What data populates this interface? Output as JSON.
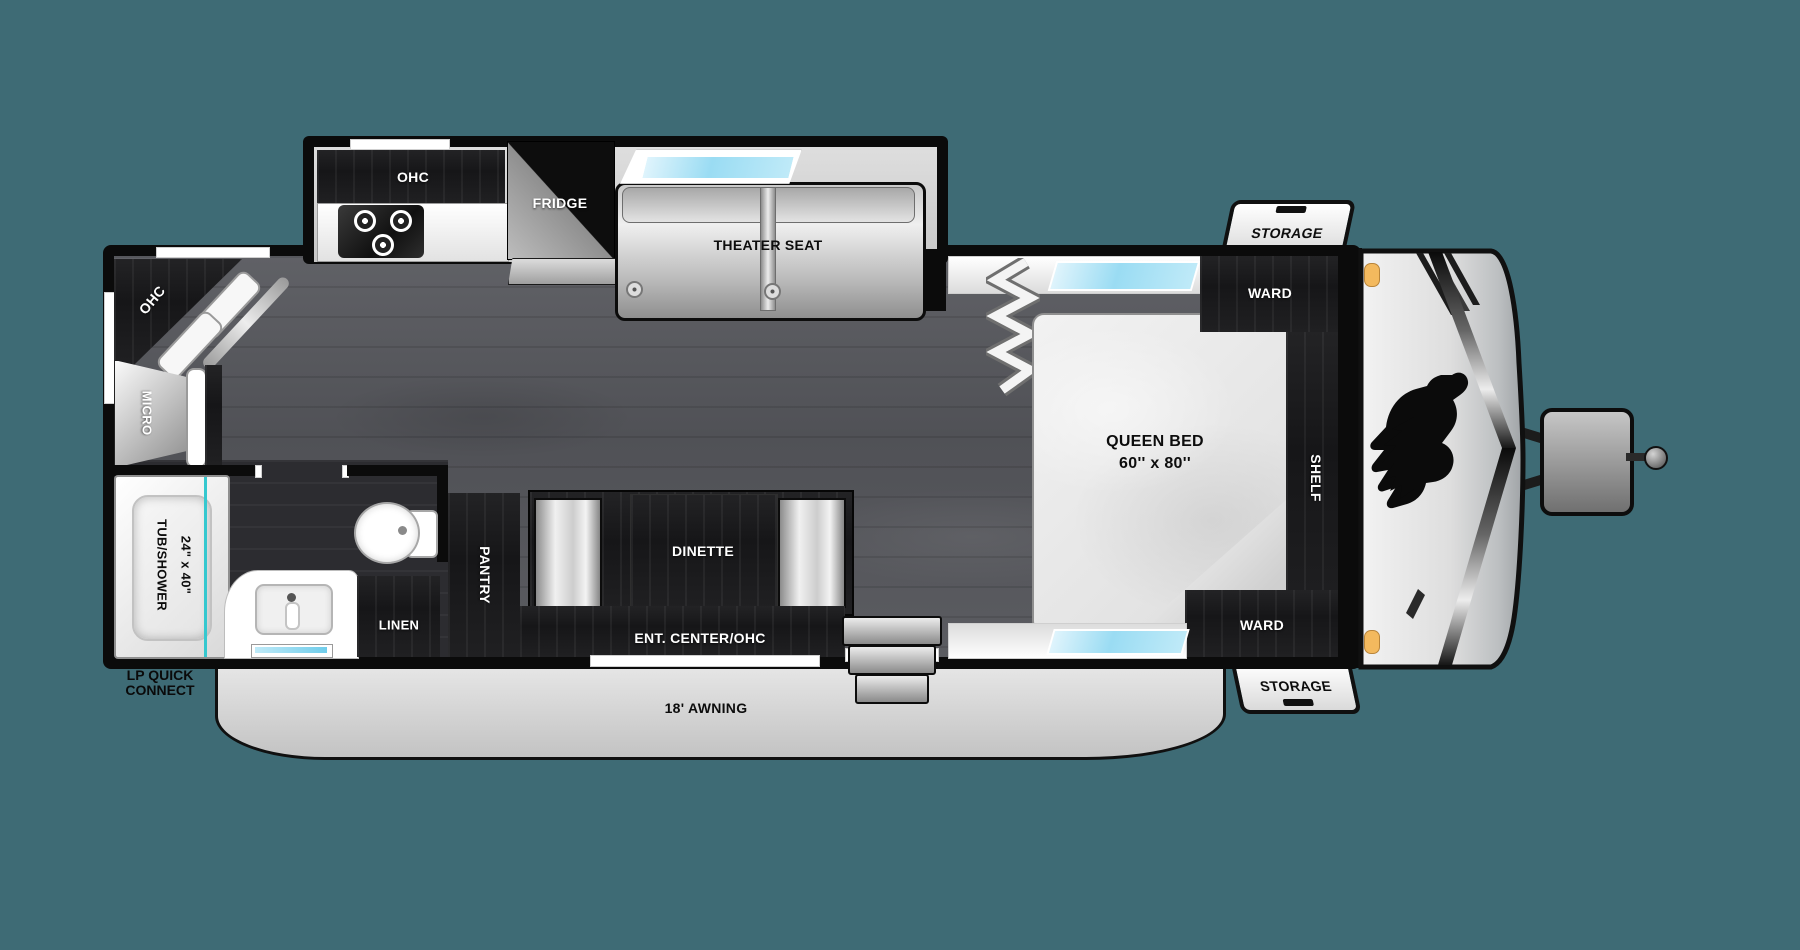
{
  "colors": {
    "background": "#3E6B75",
    "window_glass": "#9ADCF3",
    "tub_accent": "#35C8CF",
    "marker_amber": "#F3B95E"
  },
  "labels": {
    "kitchen_ohc": "OHC",
    "fridge": "FRIDGE",
    "theater_seat": "THEATER SEAT",
    "rear_ohc": "OHC",
    "micro": "MICRO",
    "tub_line1": "TUB/SHOWER",
    "tub_line2": "24\" x 40\"",
    "linen": "LINEN",
    "pantry": "PANTRY",
    "dinette": "DINETTE",
    "ent_center": "ENT. CENTER/OHC",
    "bed_line1": "QUEEN BED",
    "bed_line2": "60'' x 80''",
    "ward_top": "WARD",
    "shelf": "SHELF",
    "ward_bottom": "WARD",
    "storage_top": "STORAGE",
    "storage_bottom": "STORAGE",
    "awning": "18' AWNING",
    "lp_line1": "LP QUICK",
    "lp_line2": "CONNECT"
  }
}
